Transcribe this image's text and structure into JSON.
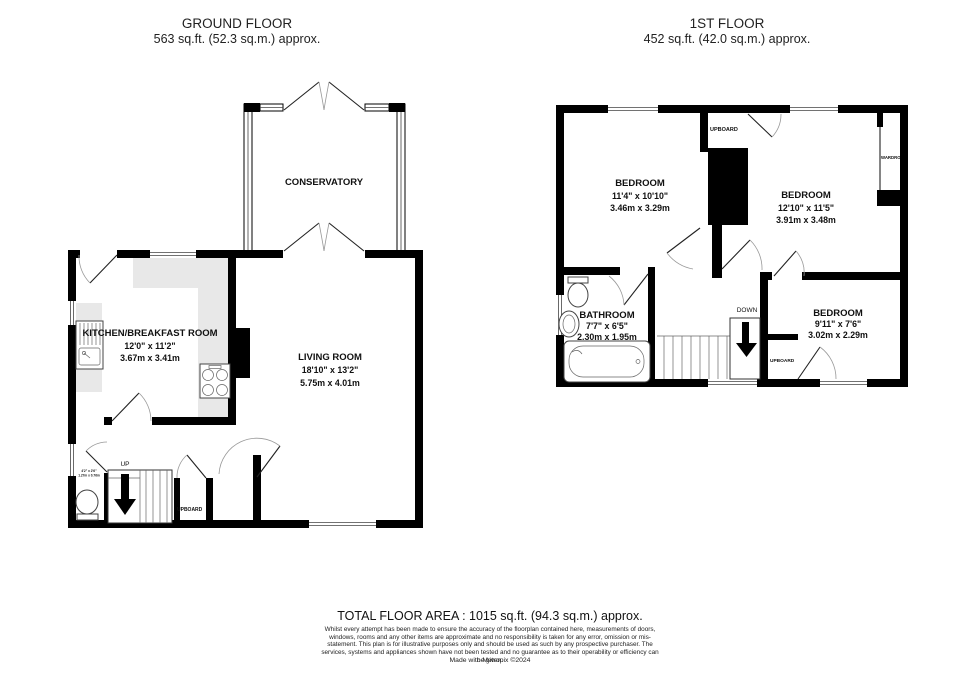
{
  "ground_floor": {
    "title": "GROUND FLOOR",
    "area": "563 sq.ft. (52.3 sq.m.) approx.",
    "conservatory": {
      "name": "CONSERVATORY"
    },
    "kitchen": {
      "name": "KITCHEN/BREAKFAST ROOM",
      "imperial": "12'0\" x 11'2\"",
      "metric": "3.67m x 3.41m"
    },
    "living_room": {
      "name": "LIVING ROOM",
      "imperial": "18'10\" x 13'2\"",
      "metric": "5.75m x 4.01m"
    },
    "stairs_label": "UP",
    "cupboard_label": "UPBOARD",
    "wc": {
      "imperial": "4'2\" x 2'6\"",
      "metric": "1.27m x 0.76m"
    }
  },
  "first_floor": {
    "title": "1ST FLOOR",
    "area": "452 sq.ft. (42.0 sq.m.) approx.",
    "bedroom1": {
      "name": "BEDROOM",
      "imperial": "11'4\" x 10'10\"",
      "metric": "3.46m x 3.29m"
    },
    "bedroom2": {
      "name": "BEDROOM",
      "imperial": "12'10\" x 11'5\"",
      "metric": "3.91m x 3.48m"
    },
    "bedroom3": {
      "name": "BEDROOM",
      "imperial": "9'11\" x 7'6\"",
      "metric": "3.02m x 2.29m"
    },
    "bathroom": {
      "name": "BATHROOM",
      "imperial": "7'7\" x 6'5\"",
      "metric": "2.30m x 1.95m"
    },
    "stairs_label": "DOWN",
    "cupboard_top_label": "UPBOARD",
    "cupboard_bottom_label": "UPBOARD",
    "wardrobe_label": "WARDROBE"
  },
  "footer": {
    "total_area": "TOTAL FLOOR AREA : 1015 sq.ft. (94.3 sq.m.) approx.",
    "disclaimer": "Whilst every attempt has been made to ensure the accuracy of the floorplan contained here, measurements of doors, windows, rooms and any other items are approximate and no responsibility is taken for any error, omission or mis-statement. This plan is for illustrative purposes only and should be used as such by any prospective purchaser. The services, systems and appliances shown have not been tested and no guarantee as to their operability or efficiency can be given.",
    "credit": "Made with Metropix ©2024"
  },
  "colors": {
    "wall": "#000000",
    "counter": "#e8e8e8",
    "text": "#1a1a1a"
  }
}
